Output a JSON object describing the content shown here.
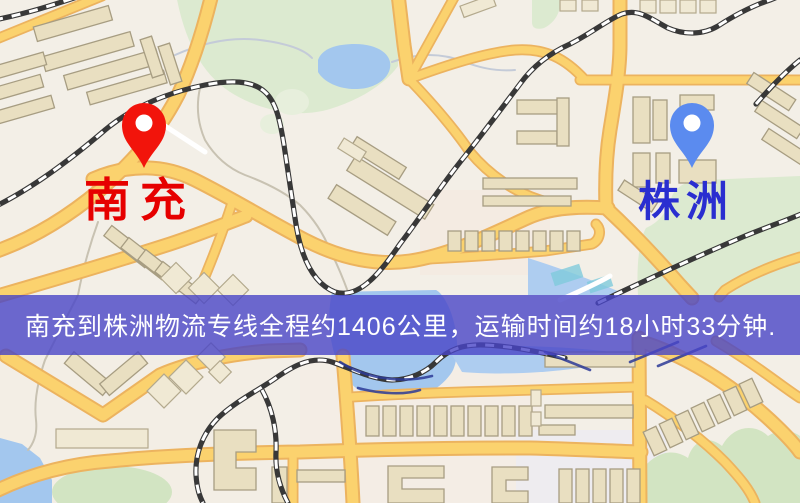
{
  "map": {
    "origin": {
      "label": "南充",
      "label_color": "#e60000",
      "pin_color": "#f2140b",
      "pin_icon": "map-pin"
    },
    "destination": {
      "label": "株洲",
      "label_color": "#2a2ed0",
      "pin_color": "#5b8bef",
      "pin_icon": "map-pin"
    }
  },
  "banner": {
    "text": "南充到株洲物流专线全程约1406公里，运输时间约18小时33分钟.",
    "background_color": "#4945c7",
    "text_color": "#ffffff",
    "origin": "南充",
    "destination": "株洲",
    "distance_km": "1406",
    "duration_hours": "18",
    "duration_minutes": "33"
  }
}
